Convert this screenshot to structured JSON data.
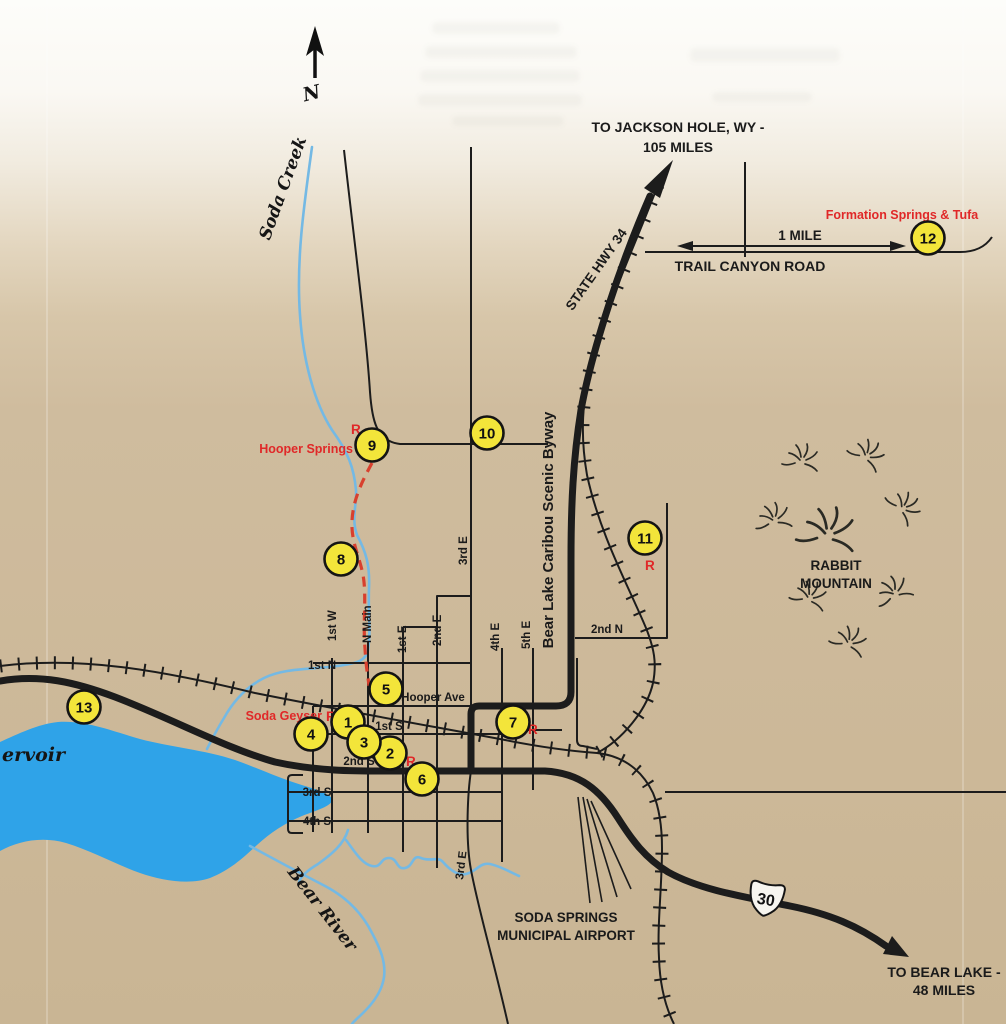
{
  "theme": {
    "bg_top": "#fbfaf6",
    "bg_map": "#cfbc9e",
    "water": "#2fa3e8",
    "stream": "#74b9e4",
    "road": "#1c1c1c",
    "marker_fill": "#f3e53a",
    "marker_stroke": "#141414",
    "red": "#e02828",
    "trail_red": "#d8402e",
    "label": "#1a1a1a"
  },
  "compass": {
    "north": "N"
  },
  "destinations": {
    "jackson_1": "TO JACKSON HOLE, WY -",
    "jackson_2": "105 MILES",
    "bear_lake_1": "TO BEAR LAKE -",
    "bear_lake_2": "48 MILES"
  },
  "routes": {
    "state_hwy_34": "STATE HWY 34",
    "byway": "Bear Lake Caribou Scenic Byway",
    "us_30": "30",
    "trail_canyon_road": "TRAIL CANYON ROAD",
    "scale_label": "1 MILE"
  },
  "water": {
    "soda_creek": "Soda Creek",
    "bear_river": "Bear River",
    "reservoir_partial": "ervoir"
  },
  "places": {
    "rabbit_1": "RABBIT",
    "rabbit_2": "MOUNTAIN",
    "airport_1": "SODA SPRINGS",
    "airport_2": "MUNICIPAL AIRPORT"
  },
  "poi": {
    "hooper_springs": "Hooper Springs",
    "soda_geyser": "Soda Geyser",
    "formation_springs": "Formation Springs & Tufa",
    "restroom_mark": "R"
  },
  "streets": {
    "first_n": "1st N",
    "second_n": "2nd N",
    "first_s": "1st S",
    "second_s": "2nd S",
    "third_s": "3rd S",
    "fourth_s": "4th S",
    "first_w": "1st W",
    "n_main": "N Main",
    "first_e": "1st E",
    "second_e": "2nd E",
    "third_e": "3rd E",
    "fourth_e": "4th E",
    "fifth_e": "5th E",
    "hooper_ave": "Hooper Ave"
  },
  "markers": [
    "1",
    "2",
    "3",
    "4",
    "5",
    "6",
    "7",
    "8",
    "9",
    "10",
    "11",
    "12",
    "13"
  ]
}
